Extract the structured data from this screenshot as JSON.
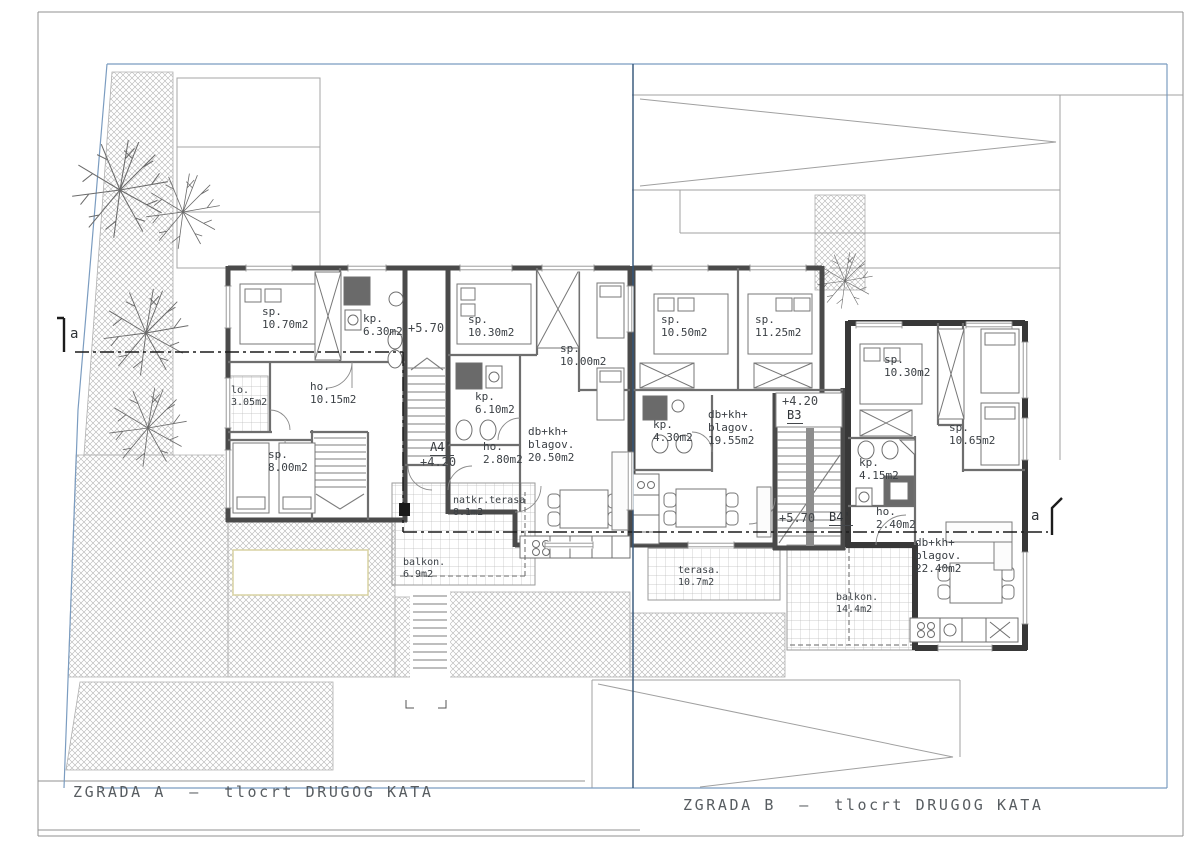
{
  "colors": {
    "boundary_blue": "#7b9cc0",
    "parcel_divider": "#35567a",
    "wall_dark": "#4a4a4a",
    "wall_darker": "#383838",
    "hatch_gray": "#b3b3b3",
    "text": "#3b4045"
  },
  "titles": {
    "building_a": "ZGRADA A  –  tlocrt DRUGOG KATA",
    "building_b": "ZGRADA B  –  tlocrt DRUGOG KATA"
  },
  "section": {
    "cut_label_left": "a",
    "cut_label_right": "a"
  },
  "building_a": {
    "stair_level": "+5.70",
    "entry_level": "+4.20",
    "entry_marker": "A4'",
    "unit_west": {
      "bedroom_1": "sp.\n10.70m2",
      "bathroom": "kp.\n6.30m2",
      "loggia": "lo.\n3.05m2",
      "hall": "ho.\n10.15m2",
      "bedroom_2": "sp.\n8.00m2"
    },
    "unit_east": {
      "bedroom_1": "sp.\n10.30m2",
      "bedroom_2": "sp.\n10.00m2",
      "bathroom": "kp.\n6.10m2",
      "hall": "ho.\n2.80m2",
      "living": "db+kh+\nblagov.\n20.50m2",
      "covered_terrace": "natkr.terasa\n8.1m2",
      "balcony": "balkon.\n6.9m2"
    }
  },
  "building_b": {
    "entry_level": "+4.20",
    "entry_marker": "B3",
    "stair_level": "+5.70",
    "stair_marker": "B4'",
    "unit_west": {
      "bedroom_1": "sp.\n10.50m2",
      "bedroom_2": "sp.\n11.25m2",
      "bathroom": "kp.\n4.30m2",
      "living": "db+kh+\nblagov.\n19.55m2",
      "terrace": "terasa.\n10.7m2"
    },
    "unit_east": {
      "bedroom_1": "sp.\n10.30m2",
      "bedroom_2": "sp.\n10.65m2",
      "bathroom": "kp.\n4.15m2",
      "hall": "ho.\n2.40m2",
      "living": "db+kh+\nblagov.\n22.40m2",
      "balcony": "balkon.\n14.4m2"
    }
  }
}
